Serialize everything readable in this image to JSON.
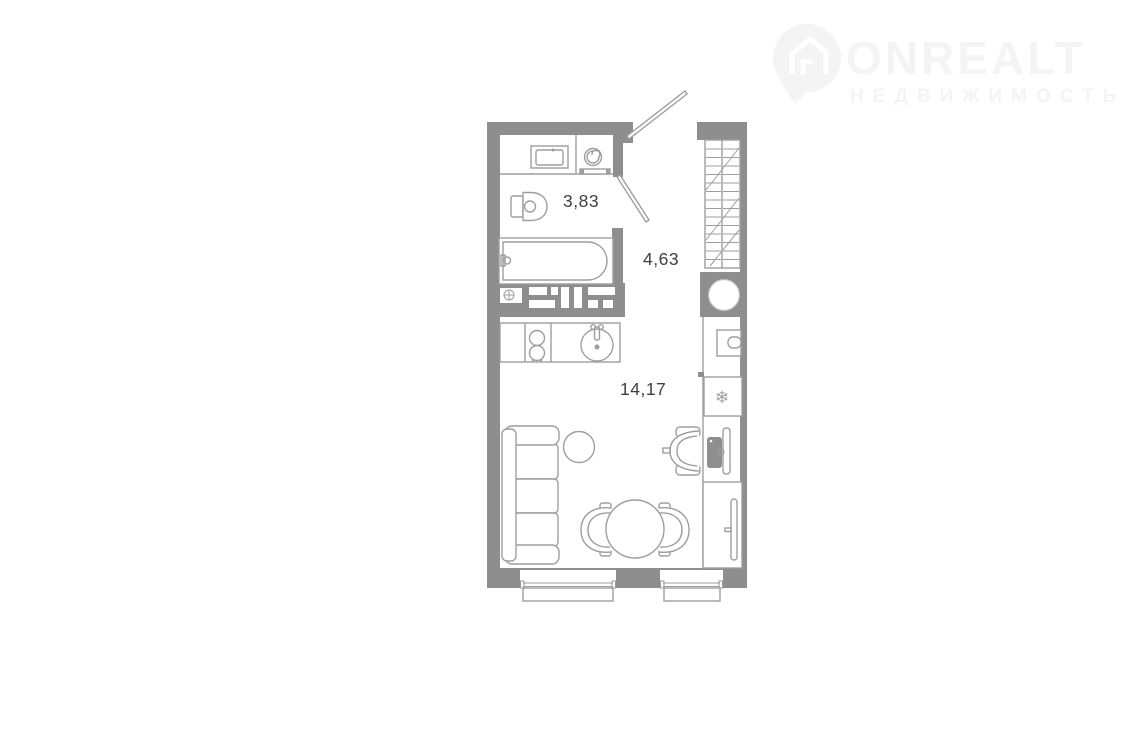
{
  "watermark": {
    "brand": "ONREALT",
    "tagline": "НЕДВИЖИМОСТЬ",
    "color": "#f4f4f4"
  },
  "floor_plan": {
    "wall_color": "#8e8e8e",
    "line_color": "#9e9e9e",
    "label_color": "#3f3f3f",
    "rooms": [
      {
        "name": "bathroom",
        "area": "3,83"
      },
      {
        "name": "hallway",
        "area": "4,63"
      },
      {
        "name": "living-kitchen",
        "area": "14,17"
      }
    ],
    "icons": {
      "freezer": "❄"
    }
  }
}
